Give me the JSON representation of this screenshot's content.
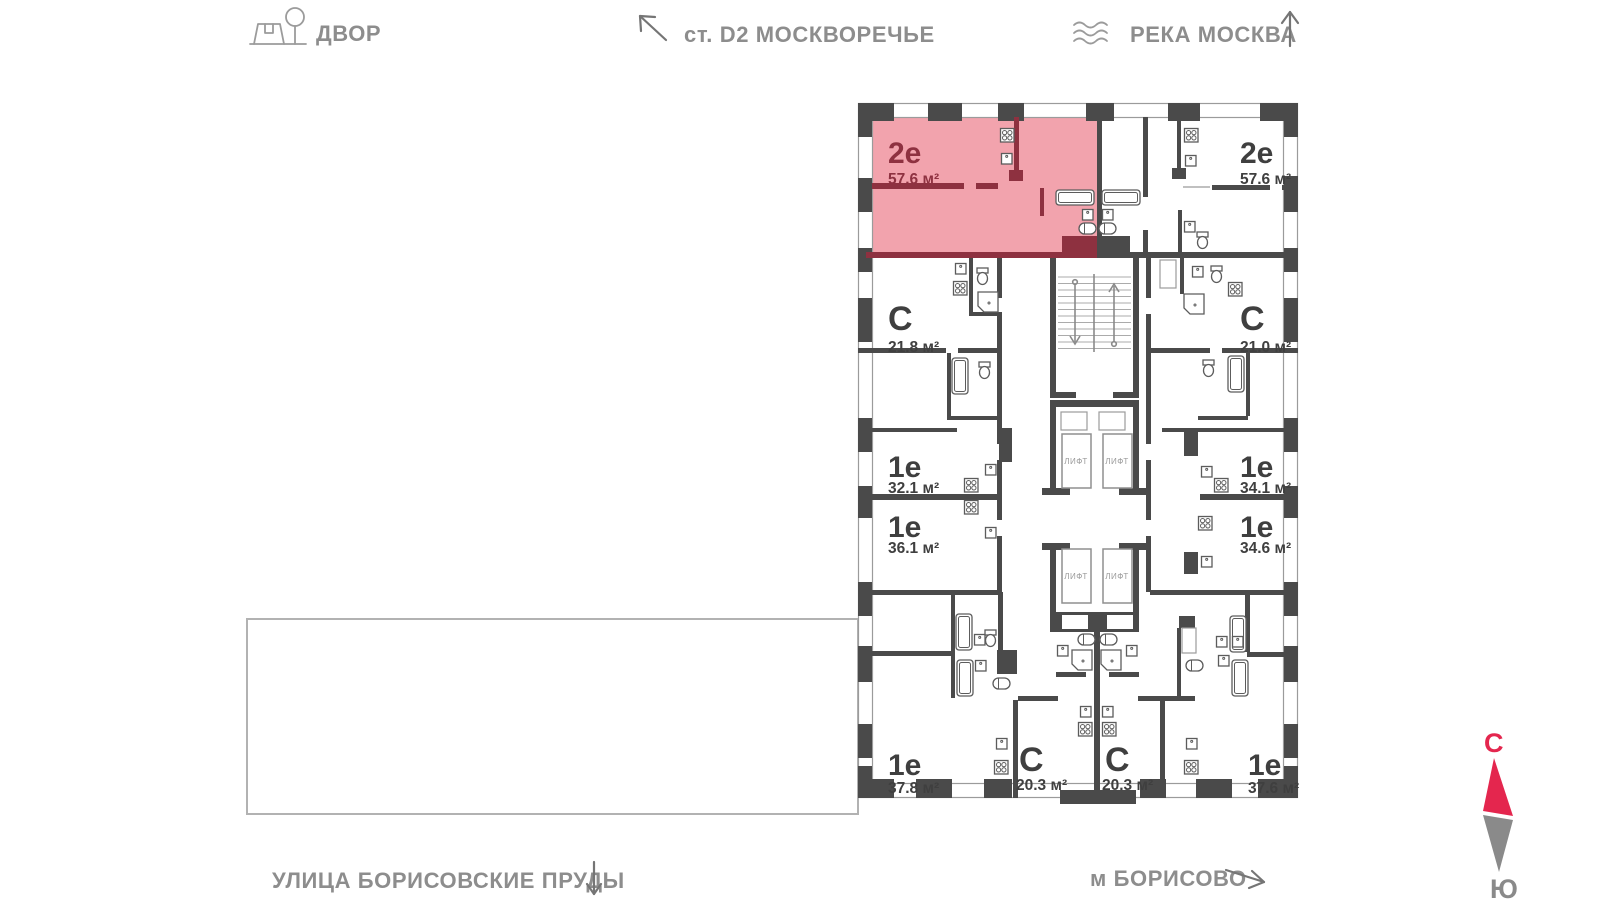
{
  "poi": {
    "courtyard": "ДВОР",
    "station": "ст. D2 МОСКВОРЕЧЬЕ",
    "river": "РЕКА МОСКВА",
    "street": "УЛИЦА БОРИСОВСКИЕ ПРУДЫ",
    "metro": "м БОРИСОВО"
  },
  "compass": {
    "north": "С",
    "south": "Ю"
  },
  "elevator": {
    "label": "ЛИФТ"
  },
  "apartments": [
    {
      "id": "2e-top-left",
      "type": "2е",
      "area": "57.6 м²",
      "highlighted": true
    },
    {
      "id": "2e-top-right",
      "type": "2е",
      "area": "57.6 м²",
      "highlighted": false
    },
    {
      "id": "c-mid-left",
      "type": "С",
      "area": "21.8 м²",
      "highlighted": false
    },
    {
      "id": "c-mid-right",
      "type": "С",
      "area": "21.0 м²",
      "highlighted": false
    },
    {
      "id": "1e-left-upper",
      "type": "1е",
      "area": "32.1 м²",
      "highlighted": false
    },
    {
      "id": "1e-right-upper",
      "type": "1е",
      "area": "34.1 м²",
      "highlighted": false
    },
    {
      "id": "1e-left-lower",
      "type": "1е",
      "area": "36.1 м²",
      "highlighted": false
    },
    {
      "id": "1e-right-lower",
      "type": "1е",
      "area": "34.6 м²",
      "highlighted": false
    },
    {
      "id": "1e-bottom-left",
      "type": "1е",
      "area": "37.8 м²",
      "highlighted": false
    },
    {
      "id": "c-bottom-left",
      "type": "С",
      "area": "20.3 м²",
      "highlighted": false
    },
    {
      "id": "c-bottom-right",
      "type": "С",
      "area": "20.3 м²",
      "highlighted": false
    },
    {
      "id": "1e-bottom-right",
      "type": "1е",
      "area": "37.6 м²",
      "highlighted": false
    }
  ],
  "colors": {
    "highlight_fill": "#f2a3ad",
    "highlight_accent": "#8e3140",
    "wall": "#4a4a4a",
    "compass_north": "#e4264e",
    "label_gray": "#8d8d8d"
  }
}
